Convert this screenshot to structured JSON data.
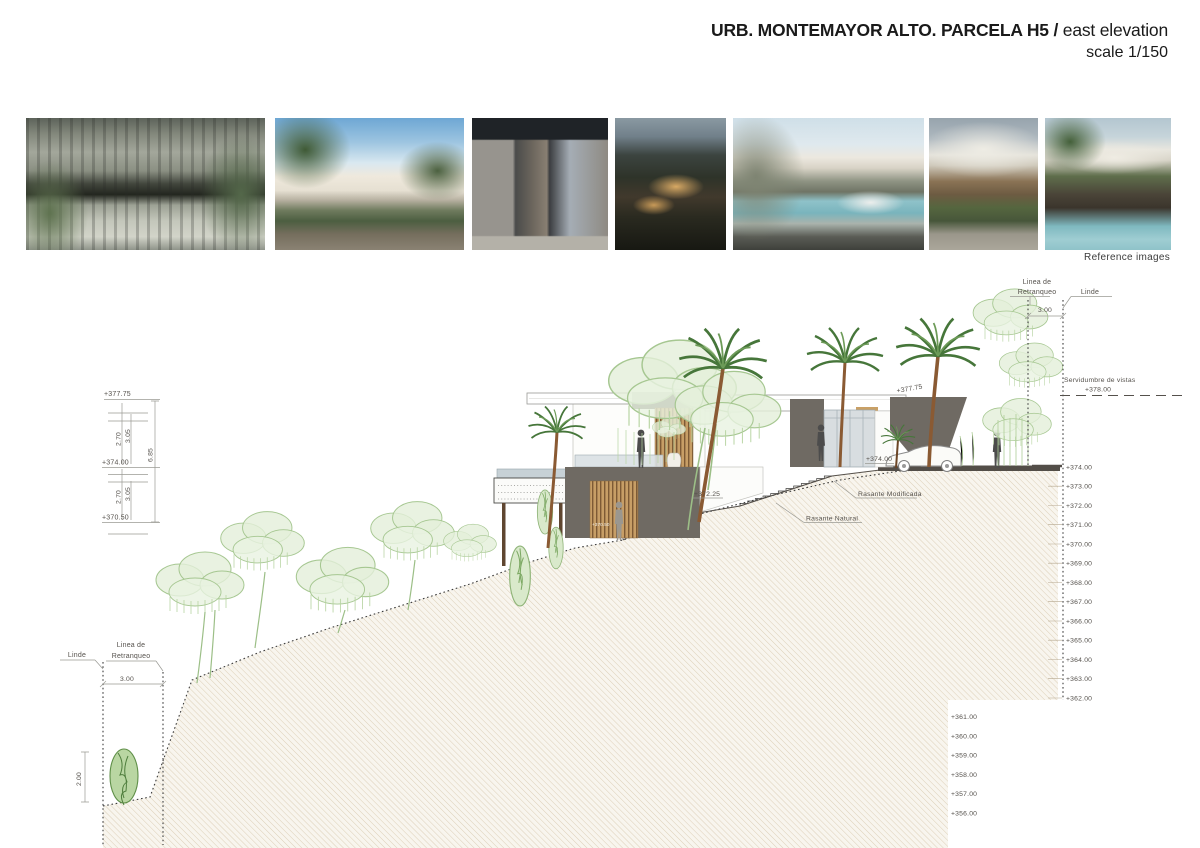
{
  "title": {
    "main_bold": "URB. MONTEMAYOR ALTO. PARCELA H5 /",
    "main_regular": " east elevation",
    "scale": "scale 1/150"
  },
  "reference": {
    "caption": "Reference images",
    "images": [
      {
        "name": "courtyard-pergola-pool"
      },
      {
        "name": "white-villa-palm-sky"
      },
      {
        "name": "stone-entrance-canopy"
      },
      {
        "name": "dark-wood-house-dusk"
      },
      {
        "name": "stone-wall-pool-car"
      },
      {
        "name": "curved-roof-wood-house"
      },
      {
        "name": "curved-roofs-palms-pool"
      }
    ]
  },
  "annotations": {
    "linea_retranqueo_line1": "Linea de",
    "linea_retranqueo_line2": "Retranqueo",
    "linde": "Linde",
    "setback_dim": "3.00",
    "servidumbre": "Servidumbre de vistas",
    "servidumbre_level": "+378.00",
    "rasante_modificada": "Rasante Modificada",
    "rasante_natural": "Rasante Natural",
    "bush_height": "2.00"
  },
  "left_dims": {
    "top_level": "+377.75",
    "mid_level": "+374.00",
    "low_level": "+370.50",
    "upper_clear": "2.70",
    "upper_floor": "3.05",
    "lower_clear": "2.70",
    "lower_floor": "3.05",
    "total": "6.85"
  },
  "building_labels": {
    "roof_level": "+377.75",
    "entry_level": "+374.00",
    "mid_level": "+372.25",
    "lower_level": "+370.50"
  },
  "scale_right": [
    "+374.00",
    "+373.00",
    "+372.00",
    "+371.00",
    "+370.00",
    "+369.00",
    "+368.00",
    "+367.00",
    "+366.00",
    "+365.00",
    "+364.00",
    "+363.00",
    "+362.00"
  ],
  "scale_lower": [
    "+361.00",
    "+360.00",
    "+359.00",
    "+358.00",
    "+357.00",
    "+356.00"
  ]
}
